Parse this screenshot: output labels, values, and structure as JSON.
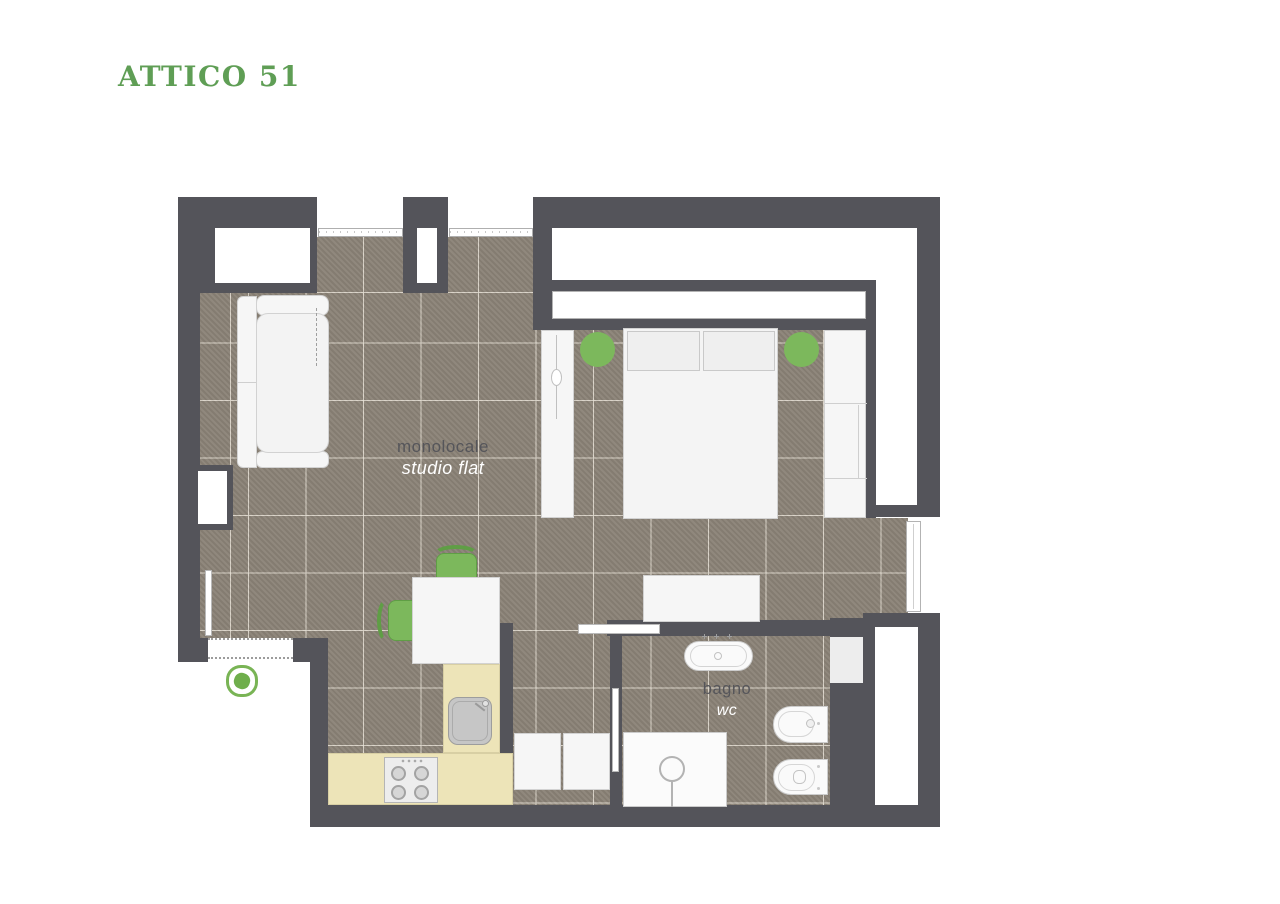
{
  "title": "ATTICO 51",
  "colors": {
    "title_green": "#5F9E55",
    "accent_green": "#7CB85C",
    "accent_green_dark": "#5F9E45",
    "wall": "#54545A",
    "floor": "#8A8276",
    "kitchen_counter": "#EDE4B8"
  },
  "rooms": {
    "studio": {
      "label_it": "monolocale",
      "label_en": "studio flat"
    },
    "bathroom": {
      "label_it": "bagno",
      "label_en": "wc"
    }
  },
  "furniture_icons": [
    "sofa-icon",
    "sofa-bed-extension-dashes",
    "dining-table-icon",
    "chair-icon",
    "kitchen-counter-icon",
    "hob-icon",
    "kitchen-sink-icon",
    "double-bed-icon",
    "pillow-icon",
    "bedside-stool-icon",
    "wardrobe-icon",
    "closet-icon",
    "dresser-icon",
    "laundry-cabinet-icon",
    "washbasin-icon",
    "bidet-icon",
    "toilet-icon",
    "shower-icon",
    "plant-icon",
    "window-icon",
    "sliding-door-icon",
    "entrance-door-icon"
  ]
}
